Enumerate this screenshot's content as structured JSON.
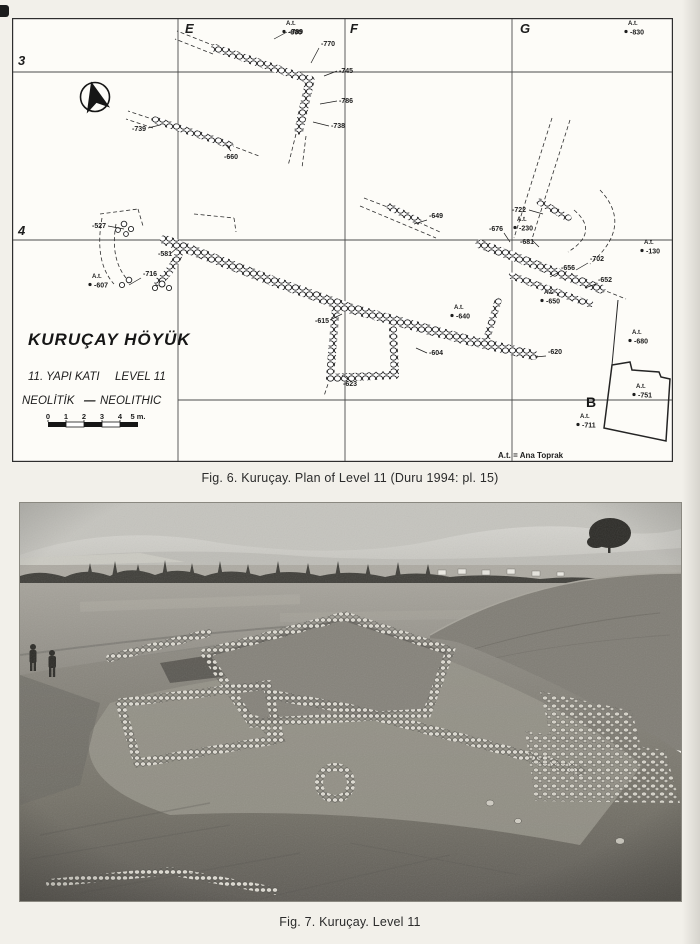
{
  "colors": {
    "ink": "#1d1d1d",
    "paper": "#f2f0ea",
    "plan_paper": "#fdfcf8"
  },
  "figure6": {
    "caption": "Fig. 6. Kuruçay. Plan of Level 11 (Duru 1994: pl. 15)",
    "plan": {
      "site_title": "KURUÇAY HÖYÜK",
      "phase_turkish": "11. YAPI KATI",
      "phase_english": "LEVEL 11",
      "period_turkish": "NEOLİTİK",
      "period_separator": "—",
      "period_english": "NEOLITHIC",
      "legend_note": "A.t. = Ana Toprak",
      "sounding_label": "B",
      "scale": {
        "ticks": [
          "0",
          "1",
          "2",
          "3",
          "4"
        ],
        "unit_label": "5 m."
      },
      "grid": {
        "columns": [
          {
            "text": "E",
            "x": 173,
            "y": 15
          },
          {
            "text": "F",
            "x": 338,
            "y": 15
          },
          {
            "text": "G",
            "x": 508,
            "y": 15
          }
        ],
        "rows": [
          {
            "text": "3",
            "x": 6,
            "y": 47
          },
          {
            "text": "4",
            "x": 6,
            "y": 217
          }
        ]
      },
      "datum_points": [
        {
          "label": "A.t.",
          "value": "-800",
          "x": 270,
          "y": 7
        },
        {
          "label": "A.t.",
          "value": "-830",
          "x": 612,
          "y": 7
        },
        {
          "label": "A.t.",
          "value": "-230",
          "x": 501,
          "y": 203
        },
        {
          "label": "A.t.",
          "value": "-130",
          "x": 628,
          "y": 226
        },
        {
          "label": "A.t.",
          "value": "-607",
          "x": 76,
          "y": 260
        },
        {
          "label": "A.t.",
          "value": "-640",
          "x": 438,
          "y": 291
        },
        {
          "label": "A.t.",
          "value": "-650",
          "x": 528,
          "y": 276
        },
        {
          "label": "A.t.",
          "value": "-680",
          "x": 616,
          "y": 316
        },
        {
          "label": "A.t.",
          "value": "-751",
          "x": 620,
          "y": 370
        },
        {
          "label": "A.t.",
          "value": "-711",
          "x": 564,
          "y": 400
        }
      ],
      "spot_elevations": [
        {
          "value": "-789",
          "x": 277,
          "y": 16,
          "lx1": 275,
          "ly1": 14,
          "lx2": 262,
          "ly2": 21
        },
        {
          "value": "-770",
          "x": 309,
          "y": 28,
          "lx1": 307,
          "ly1": 30,
          "lx2": 299,
          "ly2": 45
        },
        {
          "value": "-745",
          "x": 327,
          "y": 55,
          "lx1": 325,
          "ly1": 53,
          "lx2": 312,
          "ly2": 58
        },
        {
          "value": "-786",
          "x": 327,
          "y": 85,
          "lx1": 325,
          "ly1": 83,
          "lx2": 308,
          "ly2": 86
        },
        {
          "value": "-738",
          "x": 319,
          "y": 110,
          "lx1": 317,
          "ly1": 108,
          "lx2": 301,
          "ly2": 104
        },
        {
          "value": "-739",
          "x": 120,
          "y": 113,
          "lx1": 136,
          "ly1": 110,
          "lx2": 148,
          "ly2": 107
        },
        {
          "value": "-660",
          "x": 212,
          "y": 141,
          "lx1": 219,
          "ly1": 133,
          "lx2": 214,
          "ly2": 127
        },
        {
          "value": "-649",
          "x": 417,
          "y": 200,
          "lx1": 415,
          "ly1": 202,
          "lx2": 402,
          "ly2": 206
        },
        {
          "value": "-722",
          "x": 500,
          "y": 194,
          "lx1": 517,
          "ly1": 192,
          "lx2": 531,
          "ly2": 196
        },
        {
          "value": "-676",
          "x": 477,
          "y": 213,
          "lx1": 492,
          "ly1": 215,
          "lx2": 498,
          "ly2": 224
        },
        {
          "value": "-527",
          "x": 80,
          "y": 210,
          "lx1": 96,
          "ly1": 208,
          "lx2": 112,
          "ly2": 211
        },
        {
          "value": "-716",
          "x": 131,
          "y": 258,
          "lx1": 129,
          "ly1": 260,
          "lx2": 117,
          "ly2": 267
        },
        {
          "value": "-581",
          "x": 146,
          "y": 238,
          "lx1": 158,
          "ly1": 236,
          "lx2": 165,
          "ly2": 230
        },
        {
          "value": "-615",
          "x": 303,
          "y": 305,
          "lx1": 318,
          "ly1": 302,
          "lx2": 330,
          "ly2": 296
        },
        {
          "value": "-604",
          "x": 417,
          "y": 337,
          "lx1": 415,
          "ly1": 335,
          "lx2": 404,
          "ly2": 330
        },
        {
          "value": "-623",
          "x": 331,
          "y": 368,
          "lx1": 340,
          "ly1": 364,
          "lx2": 330,
          "ly2": 357
        },
        {
          "value": "-620",
          "x": 536,
          "y": 336,
          "lx1": 534,
          "ly1": 338,
          "lx2": 523,
          "ly2": 339
        },
        {
          "value": "-681",
          "x": 508,
          "y": 226,
          "lx1": 520,
          "ly1": 222,
          "lx2": 527,
          "ly2": 229
        },
        {
          "value": "-702",
          "x": 578,
          "y": 243,
          "lx1": 576,
          "ly1": 245,
          "lx2": 564,
          "ly2": 252
        },
        {
          "value": "-656",
          "x": 549,
          "y": 252,
          "lx1": 547,
          "ly1": 254,
          "lx2": 538,
          "ly2": 259
        },
        {
          "value": "-652",
          "x": 586,
          "y": 264,
          "lx1": 584,
          "ly1": 266,
          "lx2": 573,
          "ly2": 270
        }
      ]
    }
  },
  "figure7": {
    "caption": "Fig. 7. Kuruçay. Level 11"
  }
}
